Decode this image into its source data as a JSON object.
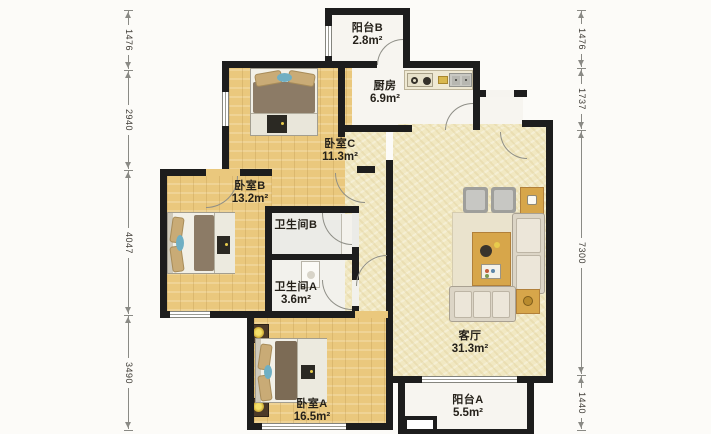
{
  "plan": {
    "title": "apartment-floor-plan",
    "rooms": [
      {
        "id": "balcony-b",
        "name": "阳台B",
        "area": "2.8m²"
      },
      {
        "id": "kitchen",
        "name": "厨房",
        "area": "6.9m²"
      },
      {
        "id": "bedroom-c",
        "name": "卧室C",
        "area": "11.3m²"
      },
      {
        "id": "bedroom-b",
        "name": "卧室B",
        "area": "13.2m²"
      },
      {
        "id": "bath-b",
        "name": "卫生间B",
        "area": ""
      },
      {
        "id": "bath-a",
        "name": "卫生间A",
        "area": "3.6m²"
      },
      {
        "id": "bedroom-a",
        "name": "卧室A",
        "area": "16.5m²"
      },
      {
        "id": "living",
        "name": "客厅",
        "area": "31.3m²"
      },
      {
        "id": "balcony-a",
        "name": "阳台A",
        "area": "5.5m²"
      }
    ],
    "dimensions": {
      "left": [
        "1476",
        "2940",
        "4047",
        "3490"
      ],
      "right": [
        "1476",
        "1737",
        "7300",
        "1440"
      ]
    },
    "colors": {
      "wall": "#1d1d1d",
      "wood_floor": "#eac87d",
      "living_floor": "#f1e8c2",
      "balcony_floor": "#f7f5f0",
      "duvet_brown": "#8c7b66",
      "pillow_tan": "#c9ab76",
      "accent_blue": "#6fafc3",
      "table_gold": "#d7a64a",
      "lamp_yellow": "#f4e06a"
    }
  }
}
